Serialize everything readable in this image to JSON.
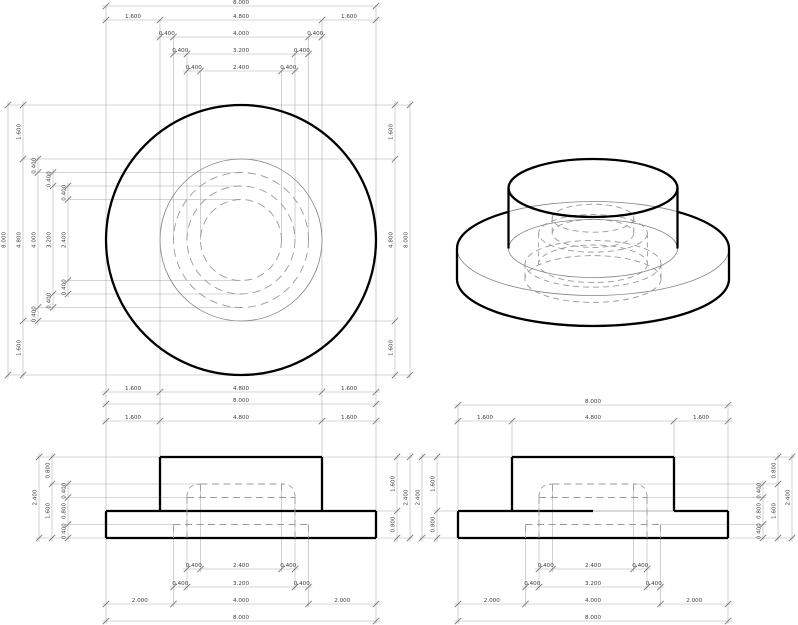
{
  "title": "flanged-cylinder-part-drawing",
  "part": {
    "flange_diameter": 8.0,
    "boss_diameter": 4.8,
    "hidden_cavity_diameters": [
      4.0,
      3.2,
      2.4
    ],
    "flange_thickness": 0.8,
    "boss_height": 1.6,
    "total_height": 2.4,
    "cavity_step_heights": [
      0.4,
      0.8,
      0.4
    ],
    "flange_margin": 1.6,
    "cavity_bottom_margin": 2.0,
    "wall_step": 0.4
  },
  "styles": {
    "thick_color": "#000000",
    "thick_w": 2.3,
    "thin_color": "#848484",
    "thin_w": 0.8,
    "dash_color": "#9a9a9a",
    "dash_w": 0.9,
    "dash_pattern": "7,4.5",
    "dim_color": "#aaaaaa",
    "dim_w": 0.55,
    "tick_color": "#787878",
    "tick_w": 0.9,
    "tick_len": 3.2,
    "label_color": "#3c3c3c",
    "label_size": 5.6,
    "ghost_color": "#b5b5b5"
  },
  "plan": {
    "cx": 241,
    "cy": 240,
    "solid_circles": [
      {
        "r": 135,
        "weight": "thick"
      },
      {
        "r": 81,
        "weight": "thin"
      }
    ],
    "dashed_radii": [
      67.5,
      54,
      40.5
    ]
  },
  "front": {
    "flange": [
      106,
      511,
      376,
      538
    ],
    "boss": [
      160,
      457,
      322,
      511
    ],
    "dashed_h": [
      [
        200.5,
        484,
        281.5
      ],
      [
        187,
        497.5,
        295
      ],
      [
        173.5,
        524.5,
        308.5
      ]
    ],
    "dashed_v": [
      [
        187,
        497,
        538
      ],
      [
        295,
        497,
        538
      ],
      [
        173.5,
        524.5,
        538
      ],
      [
        308.5,
        524.5,
        538
      ],
      [
        200.5,
        484,
        497.5
      ],
      [
        281.5,
        484,
        497.5
      ]
    ],
    "corners": [
      [
        187,
        497,
        200.5,
        484
      ],
      [
        295,
        497,
        281.5,
        484
      ]
    ]
  },
  "side": {
    "flange": [
      458,
      511,
      728,
      538
    ],
    "boss": [
      512,
      457,
      674,
      511
    ],
    "top_edge_thick": [
      [
        458,
        511,
        593,
        511
      ],
      [
        674,
        511,
        728,
        511
      ]
    ],
    "top_edge_thin": [
      [
        593,
        511,
        674,
        511
      ]
    ],
    "dashed_h": [
      [
        552.5,
        484,
        633.5
      ],
      [
        539,
        497.5,
        647
      ],
      [
        525.5,
        524.5,
        660.5
      ]
    ],
    "dashed_v": [
      [
        539,
        497,
        538
      ],
      [
        647,
        497,
        538
      ],
      [
        525.5,
        524.5,
        538
      ],
      [
        660.5,
        524.5,
        538
      ],
      [
        552.5,
        484,
        497.5
      ],
      [
        633.5,
        484,
        497.5
      ]
    ],
    "corners": [
      [
        539,
        497,
        552.5,
        484
      ],
      [
        647,
        497,
        633.5,
        484
      ]
    ]
  },
  "iso": {
    "cx": 593,
    "flange": {
      "rx": 136,
      "ry": 47,
      "top_cy": 248.5,
      "bot_cy": 279,
      "boss_edge_upper_y": 211.8,
      "left_x": 457,
      "right_x": 729,
      "boss_left_x": 508.5,
      "boss_right_x": 677.5
    },
    "boss": {
      "rx": 84.5,
      "ry": 29,
      "top_cy": 188,
      "bot_cy": 248.5
    },
    "dashed_ellipses": [
      {
        "rx": 68,
        "ry": 23.4,
        "cy": 279
      },
      {
        "rx": 68,
        "ry": 23.4,
        "cy": 263.8
      },
      {
        "rx": 54.4,
        "ry": 18.8,
        "cy": 263.8
      },
      {
        "rx": 54.4,
        "ry": 18.8,
        "cy": 233.4
      },
      {
        "rx": 40.8,
        "ry": 14,
        "cy": 233.4
      },
      {
        "rx": 40.8,
        "ry": 14,
        "cy": 218.2
      }
    ],
    "dashed_sides": [
      [
        525,
        263.8,
        525,
        279
      ],
      [
        661,
        263.8,
        661,
        279
      ],
      [
        538.6,
        233.4,
        538.6,
        263.8
      ],
      [
        647.4,
        233.4,
        647.4,
        263.8
      ],
      [
        552.2,
        218.2,
        552.2,
        233.4
      ],
      [
        633.8,
        218.2,
        633.8,
        233.4
      ]
    ]
  },
  "chains": [
    {
      "name": "plan-top-overall",
      "orient": "h",
      "pos": 6,
      "ticks": [
        106,
        376
      ],
      "labels": [
        "8.000"
      ]
    },
    {
      "name": "plan-top-flange",
      "orient": "h",
      "pos": 20,
      "ticks": [
        106,
        160,
        322,
        376
      ],
      "labels": [
        "1.600",
        "4.800",
        "1.600"
      ]
    },
    {
      "name": "plan-top-d4000",
      "orient": "h",
      "pos": 37,
      "ticks": [
        160,
        173.5,
        308.5,
        322
      ],
      "labels": [
        "0.400",
        "4.000",
        "0.400"
      ]
    },
    {
      "name": "plan-top-d3200",
      "orient": "h",
      "pos": 54,
      "ticks": [
        173.5,
        187,
        295,
        308.5
      ],
      "labels": [
        "0.400",
        "3.200",
        "0.400"
      ]
    },
    {
      "name": "plan-top-d2400",
      "orient": "h",
      "pos": 71,
      "ticks": [
        187,
        200.5,
        281.5,
        295
      ],
      "labels": [
        "0.400",
        "2.400",
        "0.400"
      ]
    },
    {
      "name": "plan-bottom-flange",
      "orient": "h",
      "pos": 392,
      "ticks": [
        106,
        160,
        322,
        376
      ],
      "labels": [
        "1.600",
        "4.800",
        "1.600"
      ]
    },
    {
      "name": "plan-bottom-overall",
      "orient": "h",
      "pos": 404,
      "ticks": [
        106,
        376
      ],
      "labels": [
        "8.000"
      ]
    },
    {
      "name": "plan-left-overall",
      "orient": "v",
      "pos": 8,
      "ticks": [
        105,
        375
      ],
      "labels": [
        "8.000"
      ]
    },
    {
      "name": "plan-left-flange",
      "orient": "v",
      "pos": 23,
      "ticks": [
        105,
        159,
        321,
        375
      ],
      "labels": [
        "1.600",
        "4.800",
        "1.600"
      ]
    },
    {
      "name": "plan-left-d4000",
      "orient": "v",
      "pos": 38,
      "ticks": [
        159,
        172.5,
        307.5,
        321
      ],
      "labels": [
        "0.400",
        "4.000",
        "0.400"
      ]
    },
    {
      "name": "plan-left-d3200",
      "orient": "v",
      "pos": 53,
      "ticks": [
        172.5,
        186,
        294,
        307.5
      ],
      "labels": [
        "0.400",
        "3.200",
        "0.400"
      ]
    },
    {
      "name": "plan-left-d2400",
      "orient": "v",
      "pos": 68,
      "ticks": [
        186,
        199.5,
        280.5,
        294
      ],
      "labels": [
        "0.400",
        "2.400",
        "0.400"
      ]
    },
    {
      "name": "plan-right-flange",
      "orient": "v",
      "pos": 395,
      "ticks": [
        105,
        159,
        321,
        375
      ],
      "labels": [
        "1.600",
        "4.800",
        "1.600"
      ]
    },
    {
      "name": "plan-right-overall",
      "orient": "v",
      "pos": 410,
      "ticks": [
        105,
        375
      ],
      "labels": [
        "8.000"
      ]
    },
    {
      "name": "front-top-flange",
      "orient": "h",
      "pos": 421,
      "ticks": [
        106,
        160,
        322,
        376
      ],
      "labels": [
        "1.600",
        "4.800",
        "1.600"
      ]
    },
    {
      "name": "front-bottom-d2400",
      "orient": "h",
      "pos": 569,
      "ticks": [
        187,
        200.5,
        281.5,
        295
      ],
      "labels": [
        "0.400",
        "2.400",
        "0.400"
      ]
    },
    {
      "name": "front-bottom-d3200",
      "orient": "h",
      "pos": 587,
      "ticks": [
        173.5,
        187,
        295,
        308.5
      ],
      "labels": [
        "0.400",
        "3.200",
        "0.400"
      ]
    },
    {
      "name": "front-bottom-d4000",
      "orient": "h",
      "pos": 604,
      "ticks": [
        106,
        173.5,
        308.5,
        376
      ],
      "labels": [
        "2.000",
        "4.000",
        "2.000"
      ]
    },
    {
      "name": "front-bottom-overall",
      "orient": "h",
      "pos": 621,
      "ticks": [
        106,
        376
      ],
      "labels": [
        "8.000"
      ]
    },
    {
      "name": "front-left-total",
      "orient": "v",
      "pos": 39,
      "ticks": [
        457,
        538
      ],
      "labels": [
        "2.400"
      ]
    },
    {
      "name": "front-left-split",
      "orient": "v",
      "pos": 52,
      "ticks": [
        457,
        484,
        538
      ],
      "labels": [
        "0.800",
        "1.600"
      ]
    },
    {
      "name": "front-left-steps",
      "orient": "v",
      "pos": 68,
      "ticks": [
        484,
        497.5,
        524.5,
        538
      ],
      "labels": [
        "0.400",
        "0.800",
        "0.400"
      ]
    },
    {
      "name": "front-right-heights",
      "orient": "v",
      "pos": 397,
      "ticks": [
        457,
        511,
        538
      ],
      "labels": [
        "1.600",
        "0.800"
      ]
    },
    {
      "name": "front-right-total",
      "orient": "v",
      "pos": 410,
      "ticks": [
        457,
        538
      ],
      "labels": [
        "2.400"
      ]
    },
    {
      "name": "side-top-overall",
      "orient": "h",
      "pos": 405,
      "ticks": [
        458,
        728
      ],
      "labels": [
        "8.000"
      ]
    },
    {
      "name": "side-top-flange",
      "orient": "h",
      "pos": 421,
      "ticks": [
        458,
        512,
        674,
        728
      ],
      "labels": [
        "1.600",
        "4.800",
        "1.600"
      ]
    },
    {
      "name": "side-bottom-d2400",
      "orient": "h",
      "pos": 569,
      "ticks": [
        539,
        552.5,
        633.5,
        647
      ],
      "labels": [
        "0.400",
        "2.400",
        "0.400"
      ]
    },
    {
      "name": "side-bottom-d3200",
      "orient": "h",
      "pos": 587,
      "ticks": [
        525.5,
        539,
        647,
        660.5
      ],
      "labels": [
        "0.400",
        "3.200",
        "0.400"
      ]
    },
    {
      "name": "side-bottom-d4000",
      "orient": "h",
      "pos": 604,
      "ticks": [
        458,
        525.5,
        660.5,
        728
      ],
      "labels": [
        "2.000",
        "4.000",
        "2.000"
      ]
    },
    {
      "name": "side-bottom-overall",
      "orient": "h",
      "pos": 621,
      "ticks": [
        458,
        728
      ],
      "labels": [
        "8.000"
      ]
    },
    {
      "name": "side-left-total",
      "orient": "v",
      "pos": 422,
      "ticks": [
        457,
        538
      ],
      "labels": [
        "2.400"
      ]
    },
    {
      "name": "side-left-heights",
      "orient": "v",
      "pos": 437,
      "ticks": [
        457,
        511,
        538
      ],
      "labels": [
        "1.600",
        "0.800"
      ]
    },
    {
      "name": "side-right-steps",
      "orient": "v",
      "pos": 763,
      "ticks": [
        484,
        497.5,
        524.5,
        538
      ],
      "labels": [
        "0.400",
        "0.800",
        "0.400"
      ]
    },
    {
      "name": "side-right-split",
      "orient": "v",
      "pos": 778,
      "ticks": [
        457,
        484,
        538
      ],
      "labels": [
        "0.800",
        "1.600"
      ]
    },
    {
      "name": "side-right-total",
      "orient": "v",
      "pos": 792,
      "ticks": [
        457,
        538
      ],
      "labels": [
        "2.400"
      ]
    }
  ],
  "ext_lines": [
    [
      106,
      6,
      106,
      511
    ],
    [
      376,
      6,
      376,
      511
    ],
    [
      160,
      20,
      160,
      457
    ],
    [
      322,
      20,
      322,
      457
    ],
    [
      173.5,
      37,
      173.5,
      240
    ],
    [
      308.5,
      37,
      308.5,
      240
    ],
    [
      187,
      54,
      187,
      240
    ],
    [
      295,
      54,
      295,
      240
    ],
    [
      200.5,
      71,
      200.5,
      240
    ],
    [
      281.5,
      71,
      281.5,
      240
    ],
    [
      8,
      105,
      410,
      105
    ],
    [
      8,
      375,
      410,
      375
    ],
    [
      23,
      159,
      395,
      159
    ],
    [
      23,
      321,
      395,
      321
    ],
    [
      38,
      172.5,
      241,
      172.5
    ],
    [
      38,
      307.5,
      241,
      307.5
    ],
    [
      53,
      186,
      241,
      186
    ],
    [
      53,
      294,
      241,
      294
    ],
    [
      68,
      199.5,
      241,
      199.5
    ],
    [
      68,
      280.5,
      241,
      280.5
    ],
    [
      106,
      538,
      106,
      624
    ],
    [
      376,
      538,
      376,
      624
    ],
    [
      173.5,
      524.5,
      173.5,
      607
    ],
    [
      308.5,
      524.5,
      308.5,
      607
    ],
    [
      187,
      497.5,
      187,
      590
    ],
    [
      295,
      497.5,
      295,
      590
    ],
    [
      200.5,
      484,
      200.5,
      572
    ],
    [
      281.5,
      484,
      281.5,
      572
    ],
    [
      36,
      457,
      160,
      457
    ],
    [
      322,
      457,
      413,
      457
    ],
    [
      49,
      484,
      200,
      484
    ],
    [
      65,
      497.5,
      187,
      497.5
    ],
    [
      65,
      524.5,
      173.5,
      524.5
    ],
    [
      36,
      538,
      106,
      538
    ],
    [
      376,
      538,
      413,
      538
    ],
    [
      376,
      511,
      400,
      511
    ],
    [
      458,
      405,
      458,
      511
    ],
    [
      728,
      405,
      728,
      511
    ],
    [
      512,
      421,
      512,
      457
    ],
    [
      674,
      421,
      674,
      457
    ],
    [
      458,
      538,
      458,
      624
    ],
    [
      728,
      538,
      728,
      624
    ],
    [
      525.5,
      524.5,
      525.5,
      607
    ],
    [
      660.5,
      524.5,
      660.5,
      607
    ],
    [
      539,
      497.5,
      539,
      590
    ],
    [
      647,
      497.5,
      647,
      590
    ],
    [
      552.5,
      484,
      552.5,
      572
    ],
    [
      633.5,
      484,
      633.5,
      572
    ],
    [
      419,
      457,
      512,
      457
    ],
    [
      674,
      457,
      795,
      457
    ],
    [
      434,
      511,
      458,
      511
    ],
    [
      419,
      538,
      458,
      538
    ],
    [
      728,
      538,
      795,
      538
    ],
    [
      633.5,
      484,
      781,
      484
    ],
    [
      647,
      497.5,
      766,
      497.5
    ],
    [
      660.5,
      524.5,
      766,
      524.5
    ]
  ]
}
